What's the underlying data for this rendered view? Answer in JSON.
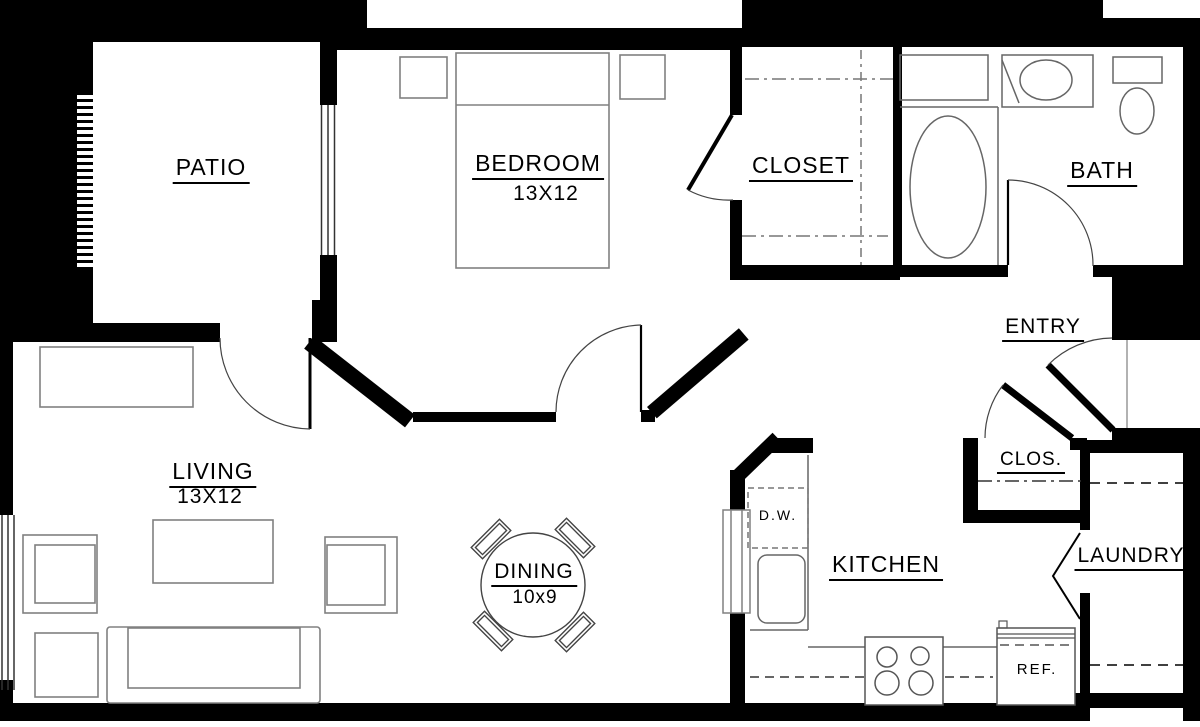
{
  "plan": {
    "type": "apartment-floor-plan",
    "rooms": {
      "patio": {
        "label": "PATIO"
      },
      "bedroom": {
        "label": "BEDROOM",
        "dims": "13X12"
      },
      "closet": {
        "label": "CLOSET"
      },
      "bath": {
        "label": "BATH"
      },
      "entry": {
        "label": "ENTRY"
      },
      "clos": {
        "label": "CLOS."
      },
      "living": {
        "label": "LIVING",
        "dims": "13X12"
      },
      "dining": {
        "label": "DINING",
        "dims": "10x9"
      },
      "kitchen": {
        "label": "KITCHEN"
      },
      "laundry": {
        "label": "LAUNDRY"
      }
    },
    "appliances": {
      "dishwasher": "D.W.",
      "refrigerator": "REF."
    },
    "colors": {
      "wall": "#000000",
      "background": "#ffffff",
      "furniture_line": "#808080",
      "fixture_line": "#666666",
      "label_text": "#000000"
    }
  }
}
